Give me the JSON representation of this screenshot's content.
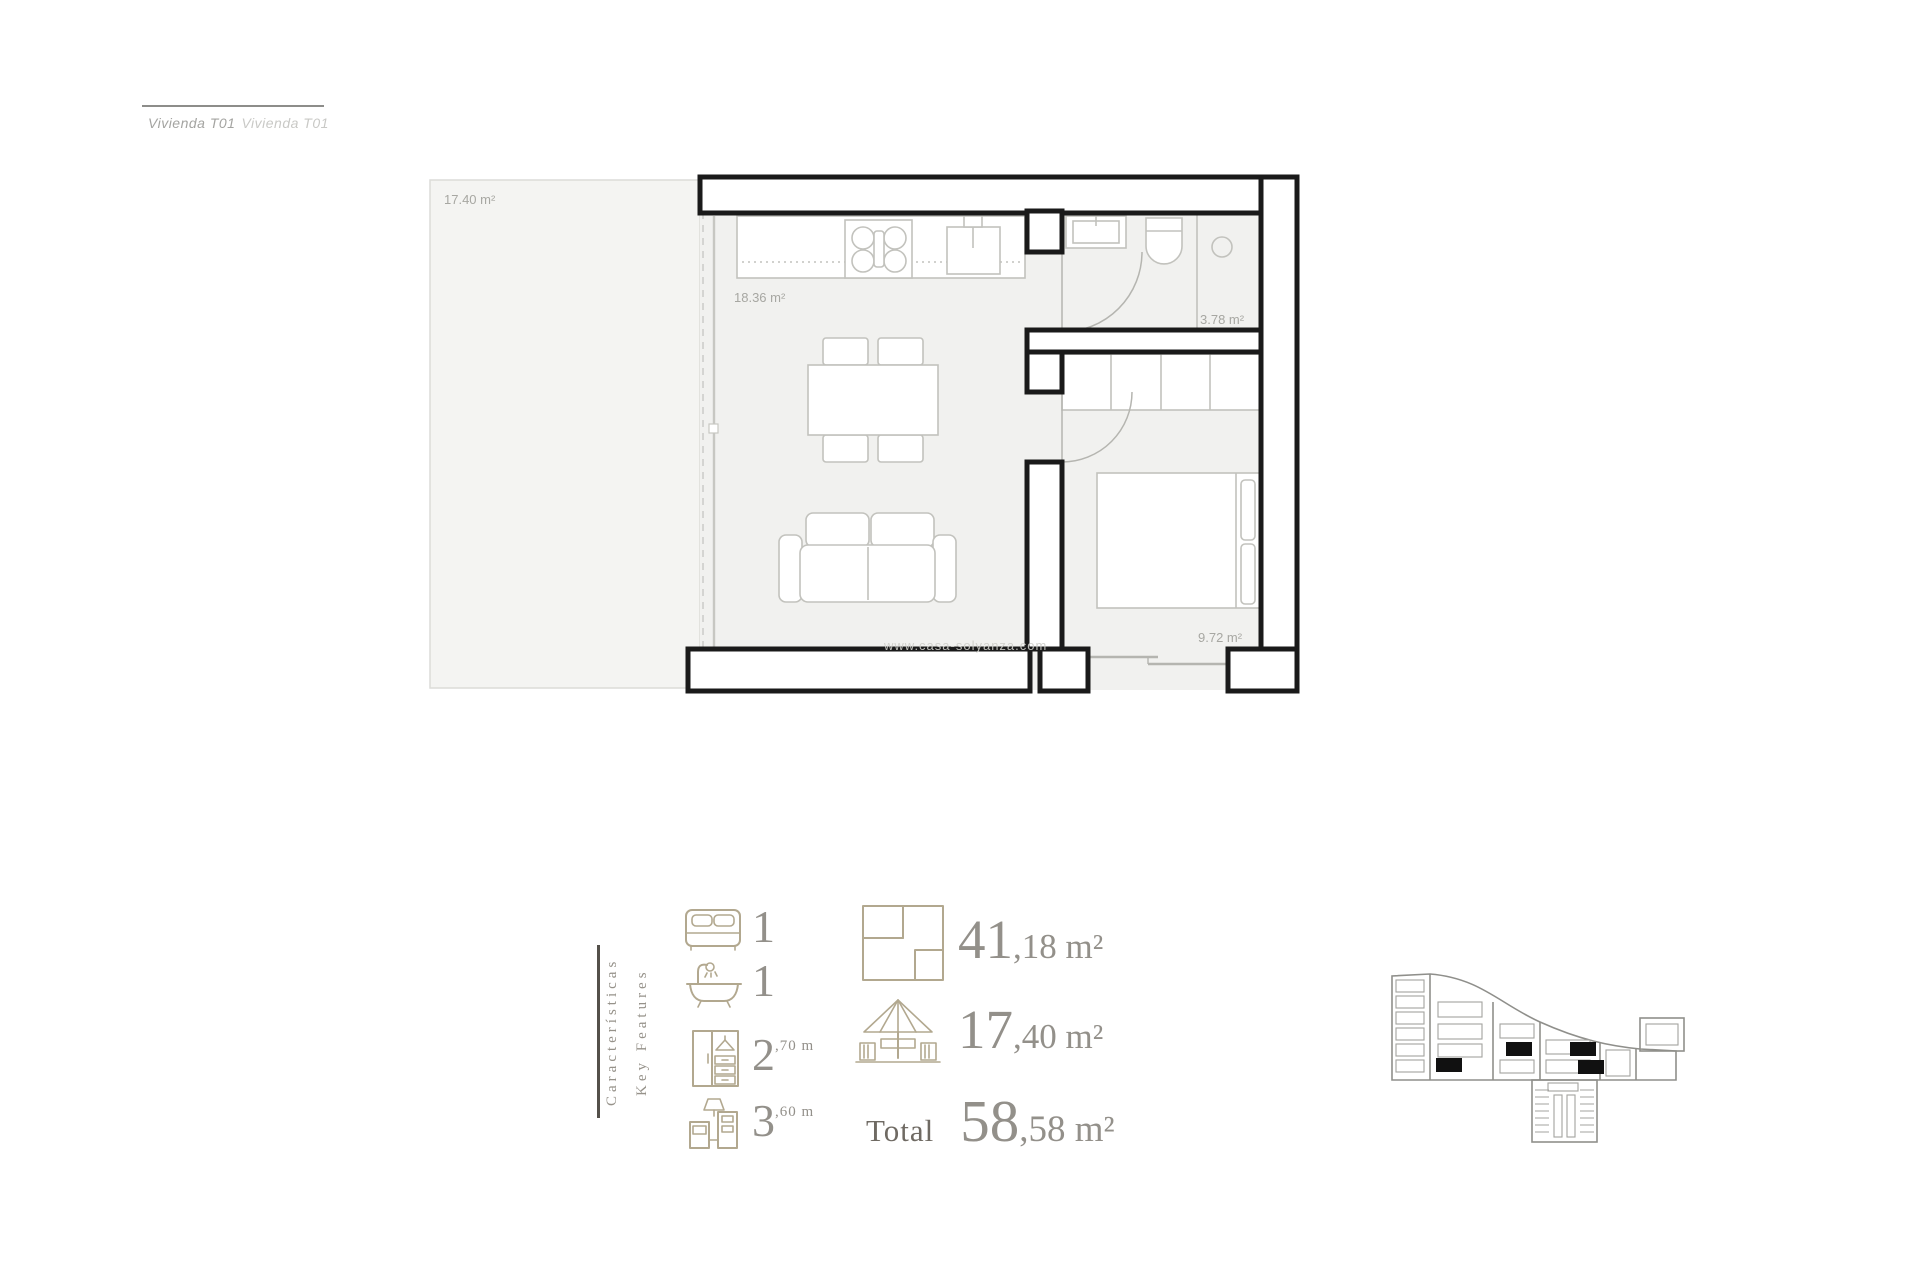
{
  "header": {
    "title_primary": "Vivienda T01",
    "title_secondary": "Vivienda T01"
  },
  "floor_plan": {
    "watermark": "www.casa-solyanza.com",
    "rooms": [
      {
        "name": "terrace",
        "area_label": "17.40 m²"
      },
      {
        "name": "kitchen-living",
        "area_label": "18.36 m²"
      },
      {
        "name": "bathroom",
        "area_label": "3.78 m²"
      },
      {
        "name": "bedroom",
        "area_label": "9.72 m²"
      }
    ]
  },
  "features": {
    "heading_es": "Características",
    "heading_en": "Key Features",
    "items": [
      {
        "icon": "bed-icon",
        "value": "1",
        "sup": ""
      },
      {
        "icon": "bathtub-icon",
        "value": "1",
        "sup": ""
      },
      {
        "icon": "wardrobe-icon",
        "value": "2",
        "sup": ",70 m"
      },
      {
        "icon": "kitchen-icon",
        "value": "3",
        "sup": ",60 m"
      }
    ],
    "areas": [
      {
        "icon": "floor-plan-icon",
        "int": "41",
        "dec": ",18 m²"
      },
      {
        "icon": "terrace-icon",
        "int": "17",
        "dec": ",40 m²"
      }
    ],
    "total_label": "Total",
    "total_int": "58",
    "total_dec": ",58 m²"
  },
  "colors": {
    "accent_beige": "#b2a88f",
    "number_gray": "#93908a",
    "total_dark": "#6f6a63",
    "wall_black": "#1a1a1a",
    "floor_gray": "#f1f1ef",
    "terrace_gray": "#f4f4f2",
    "furniture_gray": "#c2c2bd",
    "label_gray": "#a7a7a2"
  }
}
